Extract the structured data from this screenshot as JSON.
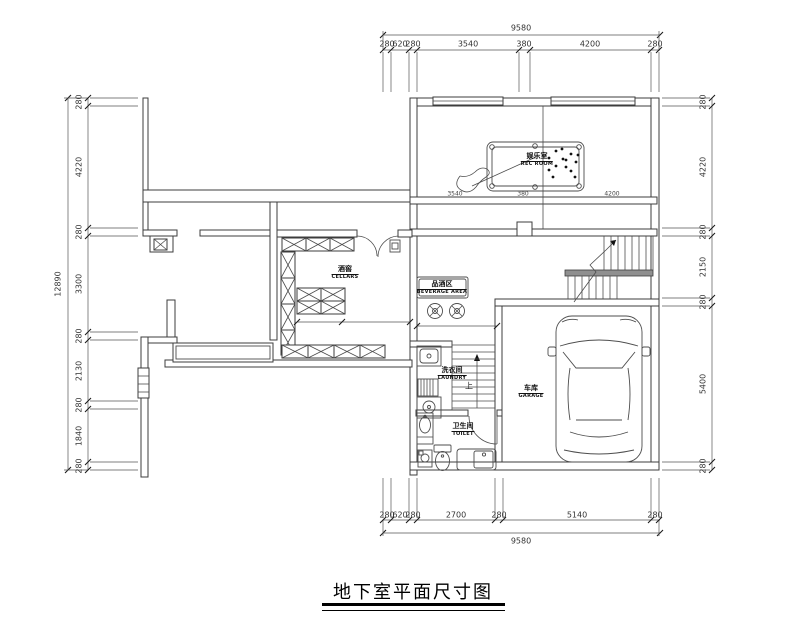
{
  "page_title": "地下室平面尺寸图",
  "rooms": [
    {
      "id": "rec-room",
      "zh": "娱乐室",
      "en": "REC ROOM"
    },
    {
      "id": "cellars",
      "zh": "酒窖",
      "en": "CELLARS"
    },
    {
      "id": "beverage-area",
      "zh": "品酒区",
      "en": "BEVERAGE AREA"
    },
    {
      "id": "laundry",
      "zh": "洗衣间",
      "en": "LAUNDRY"
    },
    {
      "id": "toilet",
      "zh": "卫生间",
      "en": "TOILET"
    },
    {
      "id": "garage",
      "zh": "车库",
      "en": "GARAGE"
    }
  ],
  "labels": {
    "stair_up": "上"
  },
  "dimensions": {
    "top": {
      "total": "9580",
      "segments": [
        "280",
        "620",
        "280",
        "3540",
        "380",
        "4200",
        "280"
      ]
    },
    "bottom": {
      "total": "9580",
      "segments": [
        "280",
        "620",
        "280",
        "2700",
        "280",
        "5140",
        "280"
      ]
    },
    "left": {
      "total": "12890",
      "segments": [
        "280",
        "4220",
        "280",
        "3300",
        "280",
        "2130",
        "280",
        "1840",
        "280"
      ]
    },
    "right": {
      "segments": [
        "280",
        "4220",
        "280",
        "2150",
        "280",
        "5400",
        "280"
      ]
    },
    "interior": [
      "3540",
      "380",
      "4200"
    ]
  },
  "colors": {
    "line": "#3c3c3c",
    "dim_text": "#333333",
    "railing": "#8f8f8f"
  }
}
